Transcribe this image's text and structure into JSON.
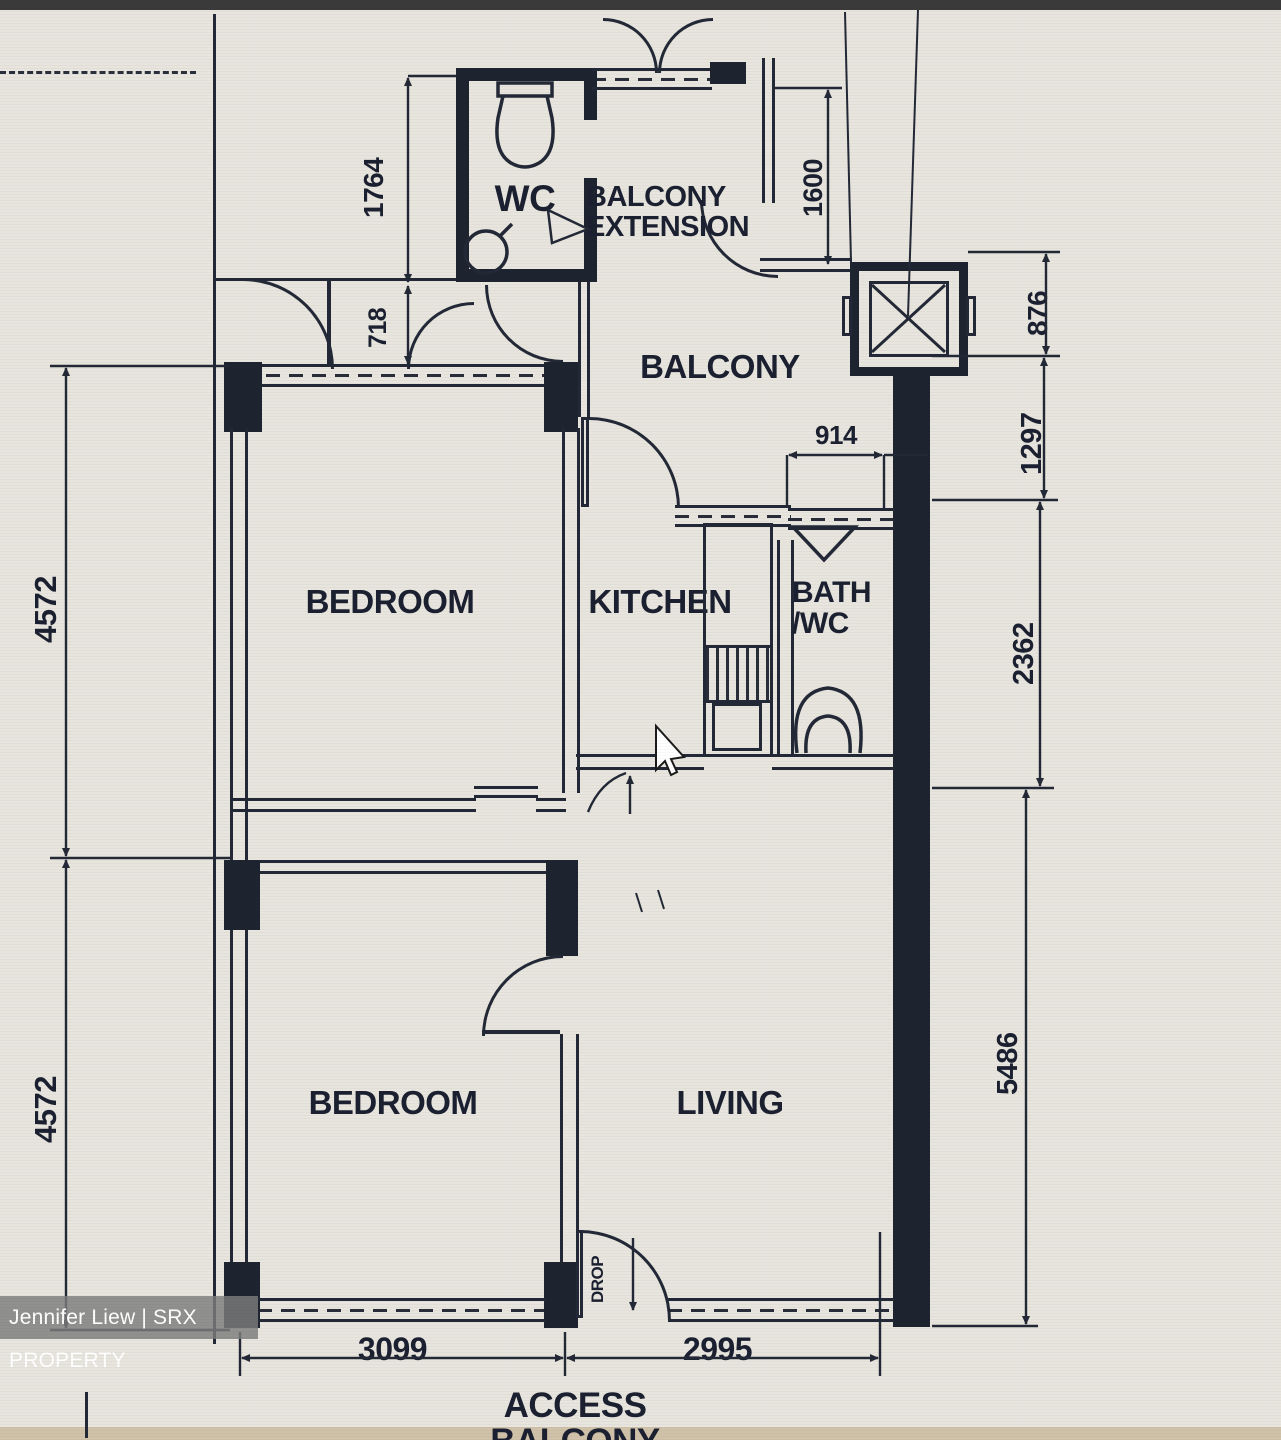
{
  "plan_title": "2-room HDB resale flat floor plan",
  "watermark": {
    "text": "Jennifer Liew | SRX PROPERTY"
  },
  "rooms": {
    "wc": "WC",
    "balcony_extension": "BALCONY\nEXTENSION",
    "balcony": "BALCONY",
    "bedroom_top": "BEDROOM",
    "kitchen": "KITCHEN",
    "bath": "BATH\n/WC",
    "bedroom_bottom": "BEDROOM",
    "living": "LIVING",
    "access_balcony": "ACCESS BALCONY",
    "drop": "DROP"
  },
  "dimensions": {
    "left_top": "4572",
    "left_bottom": "4572",
    "wc_height": "1764",
    "door_offset": "718",
    "balcony_ext_height": "1600",
    "right_chute": "876",
    "right_balcony": "1297",
    "right_kitchen": "2362",
    "right_living": "5486",
    "bath_width": "914",
    "bottom_bedroom": "3099",
    "bottom_living": "2995"
  },
  "colors": {
    "paper": "#e7e5dd",
    "line": "#232836",
    "wall": "#1e2330",
    "watermark_bg": "#7d7d7d",
    "top_bar": "#3a3a3a",
    "bottom_strip": "#d0c1a9"
  }
}
